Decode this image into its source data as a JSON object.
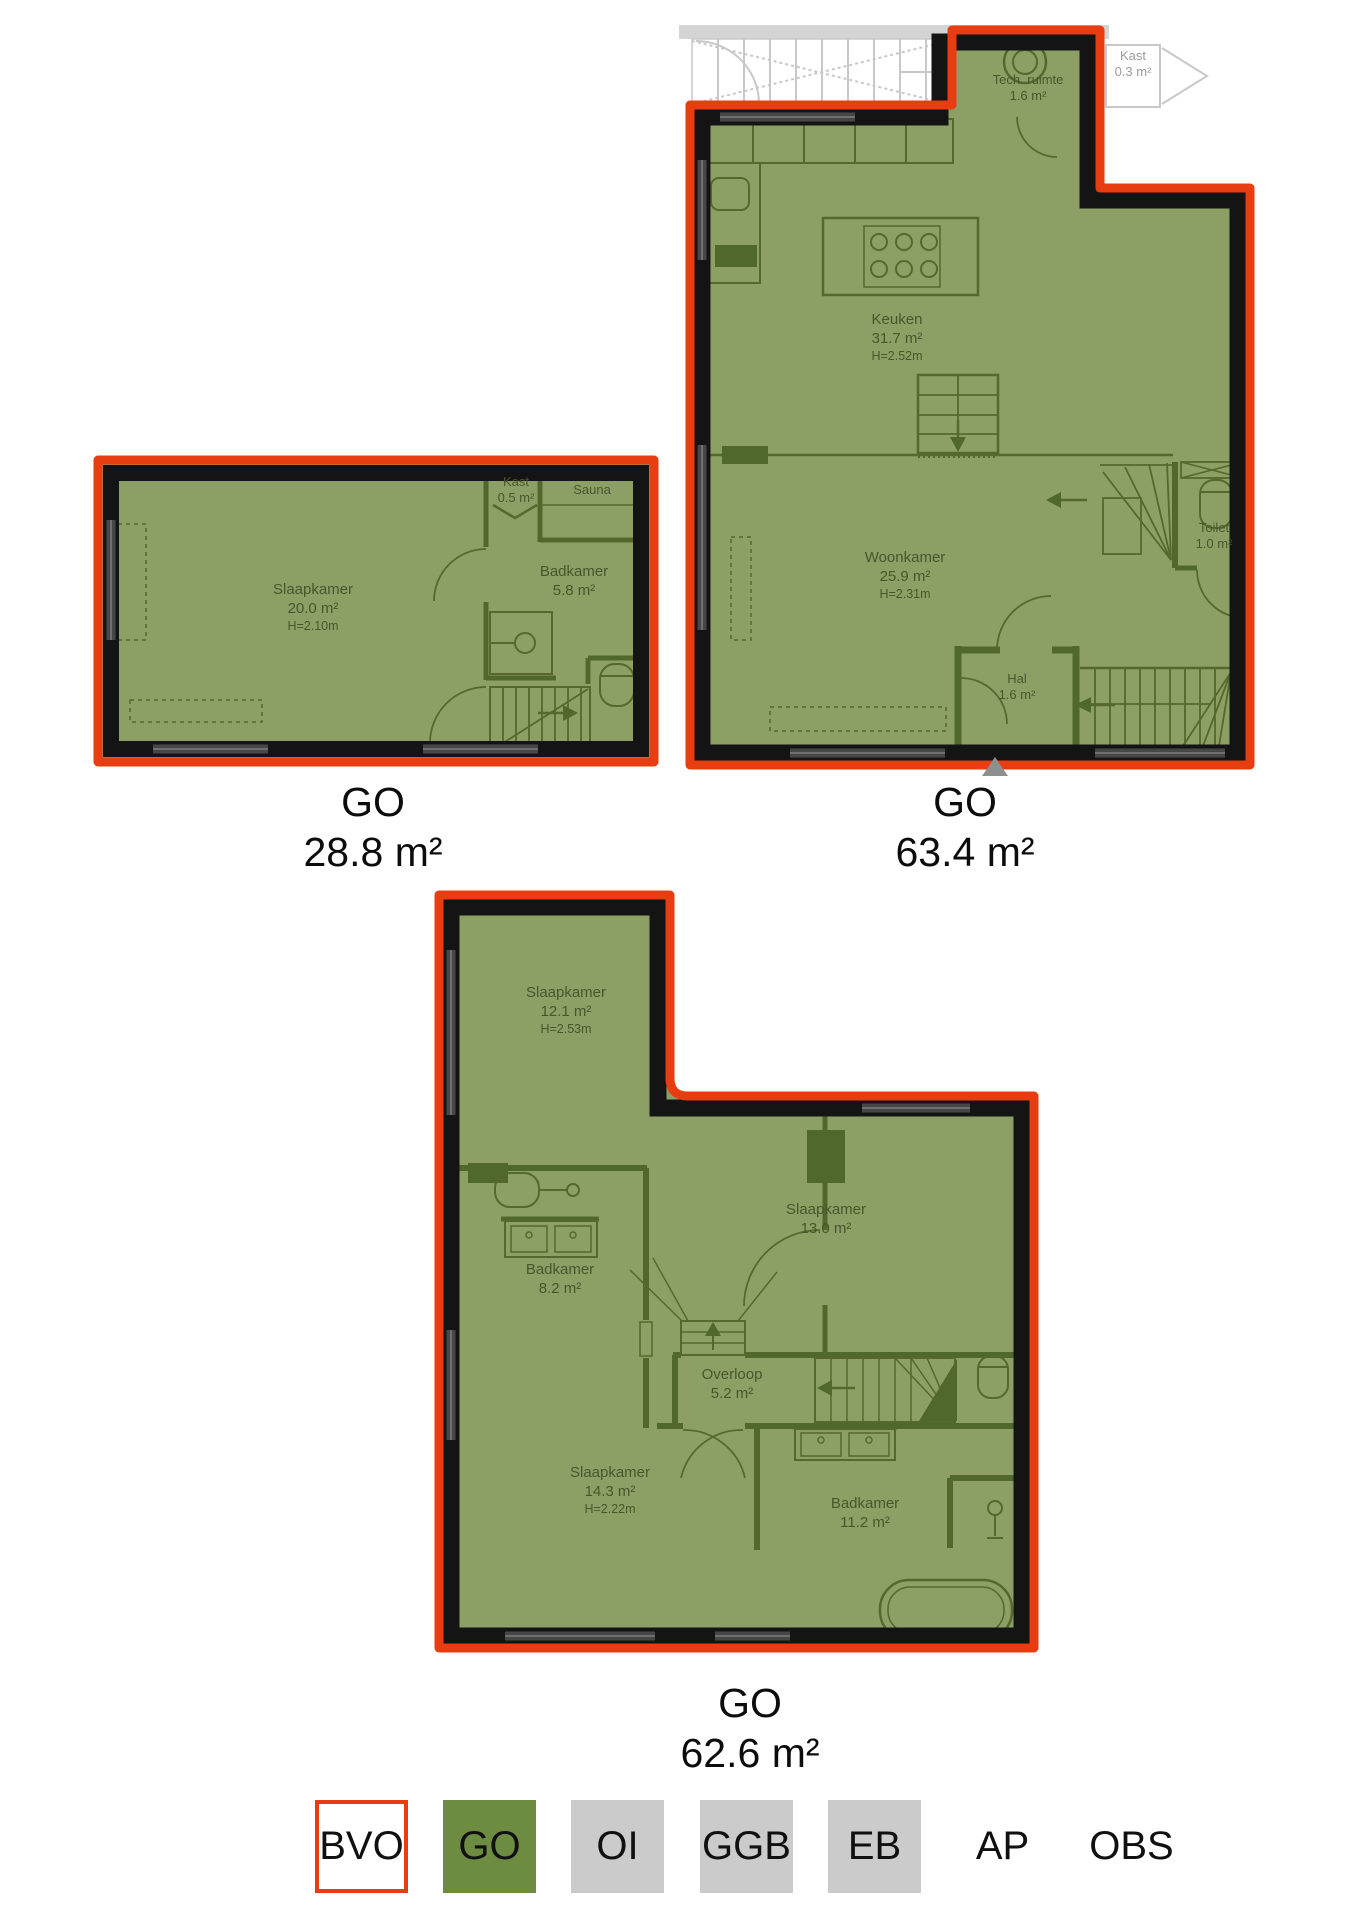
{
  "plans": [
    {
      "caption": {
        "line1": "GO",
        "line2": "28.8 m²"
      },
      "rooms": [
        {
          "name": "Slaapkamer",
          "area": "20.0 m²",
          "height": "H=2.10m"
        },
        {
          "name": "Kast",
          "area": "0.5 m²"
        },
        {
          "name": "Sauna",
          "area": "",
          "height": ""
        },
        {
          "name": "Badkamer",
          "area": "5.8 m²"
        }
      ]
    },
    {
      "caption": {
        "line1": "GO",
        "line2": "63.4 m²"
      },
      "rooms": [
        {
          "name": "Tech. ruimte",
          "area": "1.6 m²"
        },
        {
          "name": "Kast",
          "area": "0.3 m²"
        },
        {
          "name": "Keuken",
          "area": "31.7 m²",
          "height": "H=2.52m"
        },
        {
          "name": "Woonkamer",
          "area": "25.9 m²",
          "height": "H=2.31m"
        },
        {
          "name": "Toilet",
          "area": "1.0 m²"
        },
        {
          "name": "Hal",
          "area": "1.6 m²"
        }
      ]
    },
    {
      "caption": {
        "line1": "GO",
        "line2": "62.6 m²"
      },
      "rooms": [
        {
          "name": "Slaapkamer",
          "area": "12.1 m²",
          "height": "H=2.53m"
        },
        {
          "name": "Slaapkamer",
          "area": "13.0 m²"
        },
        {
          "name": "Badkamer",
          "area": "8.2 m²"
        },
        {
          "name": "Overloop",
          "area": "5.2 m²"
        },
        {
          "name": "Slaapkamer",
          "area": "14.3 m²",
          "height": "H=2.22m"
        },
        {
          "name": "Badkamer",
          "area": "11.2 m²"
        }
      ]
    }
  ],
  "legend": {
    "items": [
      {
        "label": "BVO",
        "style": "outlined-red"
      },
      {
        "label": "GO",
        "style": "green"
      },
      {
        "label": "OI",
        "style": "gray"
      },
      {
        "label": "GGB",
        "style": "gray"
      },
      {
        "label": "EB",
        "style": "gray"
      },
      {
        "label": "AP",
        "style": "text"
      },
      {
        "label": "OBS",
        "style": "text"
      }
    ]
  },
  "colors": {
    "outline_red": "#e83c11",
    "overlay_green": "#8ca065",
    "legend_green": "#6d8c42",
    "legend_gray": "#cbcbcb",
    "wall_black": "#141414",
    "plan_line": "#55682e"
  }
}
